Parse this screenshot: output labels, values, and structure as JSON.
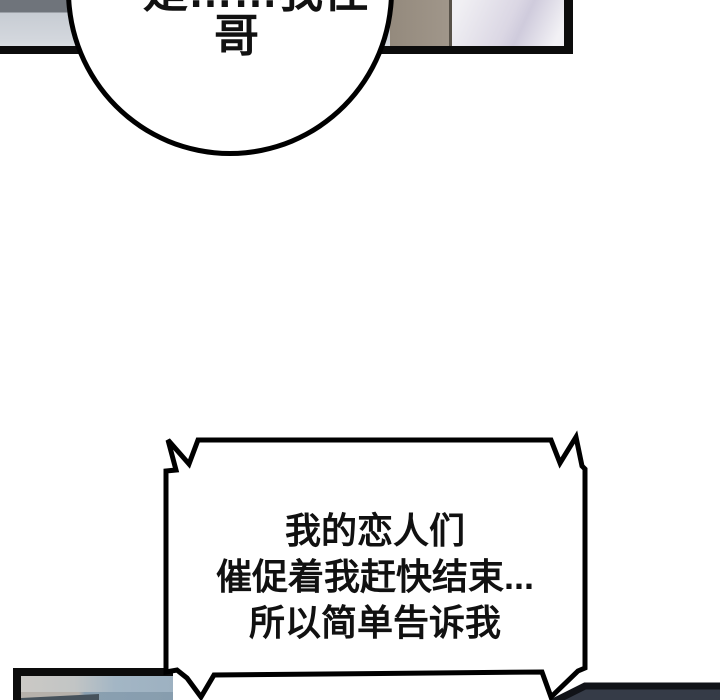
{
  "page": {
    "background": "#ffffff",
    "type_label": "webtoon comic page"
  },
  "colors": {
    "panel_border": "#0c0c0c",
    "bubble_outline": "#000000",
    "bubble_fill": "#ffffff",
    "top_left_wall_dark": "#6f747b",
    "top_left_wall_light": "#d3d7dd",
    "top_taupe_block": "#9a9083",
    "top_lavender_block": "#e3e0ea",
    "bottom_left_warm_gray": "#cbc9c5",
    "bottom_left_steel_blue": "#9db1c1",
    "bottom_right_dark_panel": "#353b47"
  },
  "speech_bubble_top": {
    "line1": "是……我住",
    "line2": "哥"
  },
  "speech_bubble_main": {
    "line1": "我的恋人们",
    "line2": "催促着我赶快结束...",
    "line3": "所以简单告诉我"
  }
}
